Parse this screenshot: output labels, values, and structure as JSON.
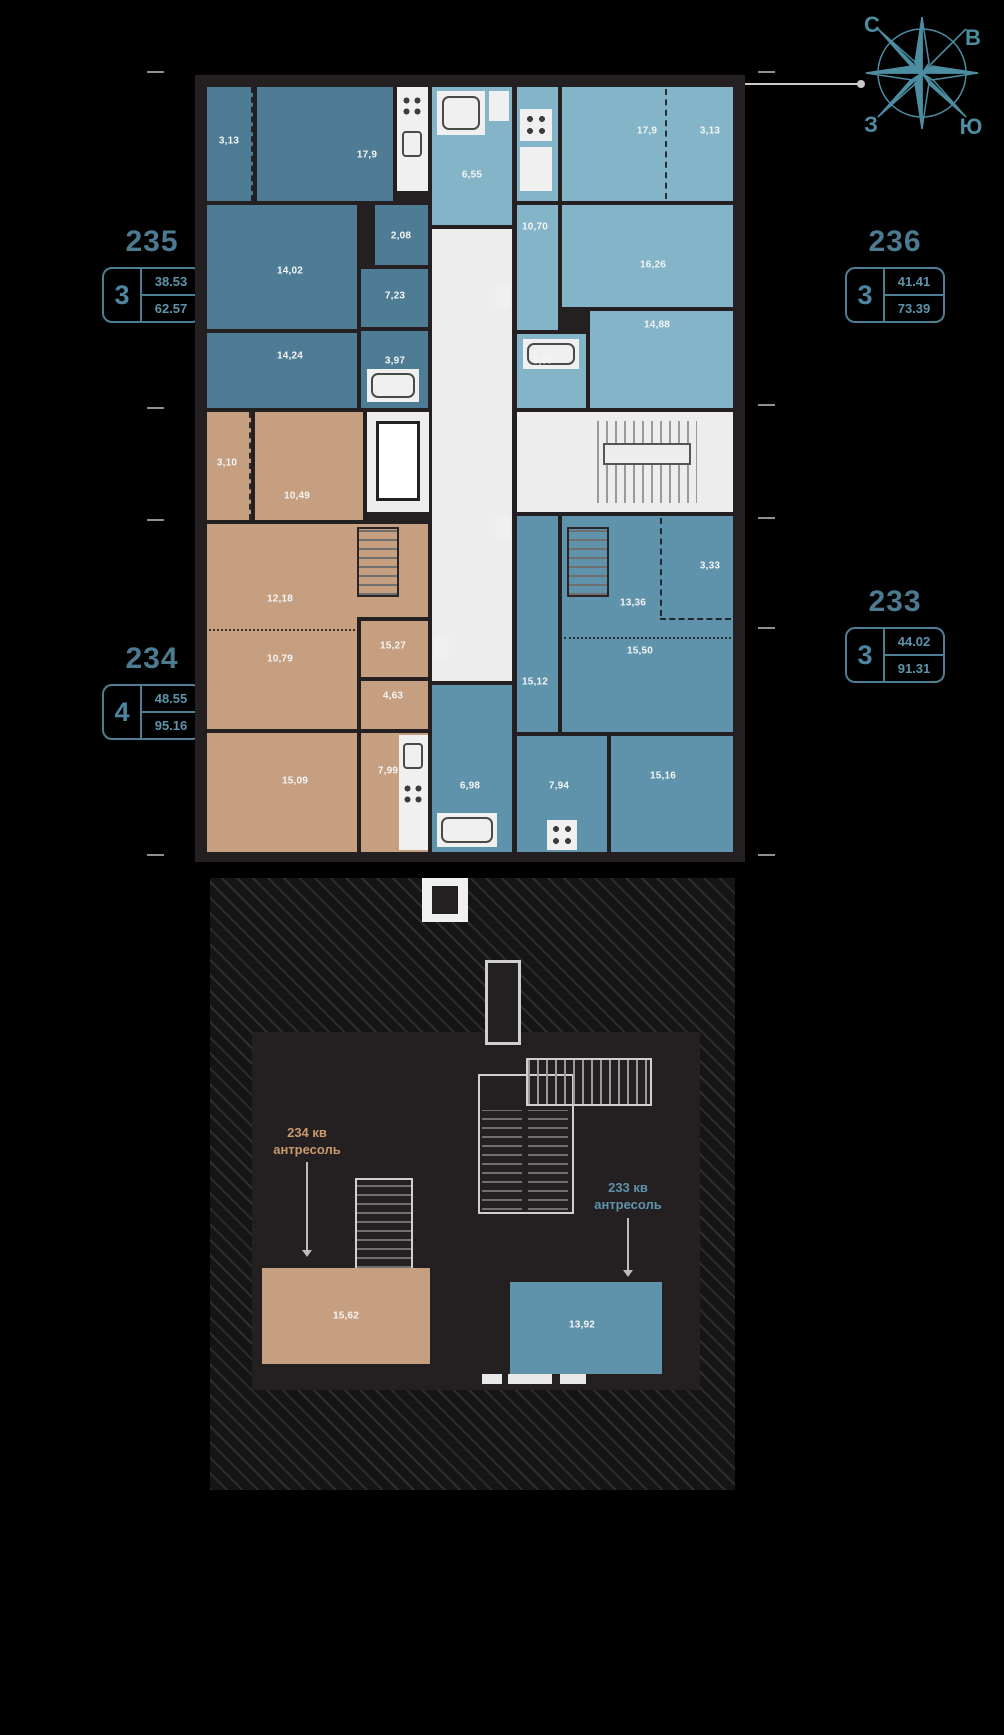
{
  "compass": {
    "n": "С",
    "e": "В",
    "w": "З",
    "s": "Ю"
  },
  "apartments": {
    "a235": {
      "number": "235",
      "rooms": "3",
      "living_area": "38.53",
      "total_area": "62.57"
    },
    "a236": {
      "number": "236",
      "rooms": "3",
      "living_area": "41.41",
      "total_area": "73.39"
    },
    "a234": {
      "number": "234",
      "rooms": "4",
      "living_area": "48.55",
      "total_area": "95.16"
    },
    "a233": {
      "number": "233",
      "rooms": "3",
      "living_area": "44.02",
      "total_area": "91.31"
    }
  },
  "plan": {
    "a235": {
      "balcony": "3,13",
      "room1": "17,9",
      "room2": "14,02",
      "wardrobe": "2,08",
      "hall": "7,23",
      "room3": "14,24",
      "bath": "3,97"
    },
    "a236": {
      "kitchen": "6,55",
      "room1": "17,9",
      "balcony": "3,13",
      "hall": "10,70",
      "room2": "16,26",
      "room3": "14,88",
      "bath": "3,97"
    },
    "a234": {
      "balcony": "3,10",
      "room1": "10,49",
      "room2": "12,18",
      "room3": "10,79",
      "hall": "15,27",
      "bath": "4,63",
      "kitchen": "7,99",
      "room4": "15,09"
    },
    "a233": {
      "balcony": "3,33",
      "room1": "13,36",
      "room2": "15,50",
      "hall": "15,12",
      "kitchen": "6,98",
      "room3": "7,94",
      "room4": "15,16"
    }
  },
  "mezzanine": {
    "label_234_line1": "234 кв",
    "label_234_line2": "антресоль",
    "label_233_line1": "233 кв",
    "label_233_line2": "антресоль",
    "room_234": "15,62",
    "room_233": "13,92"
  },
  "colors": {
    "apt235": "#4d7c94",
    "apt236": "#83b4c8",
    "apt234": "#c59f80",
    "apt233": "#5e93ab",
    "accent": "#4c8da1",
    "wall": "#241f21"
  }
}
